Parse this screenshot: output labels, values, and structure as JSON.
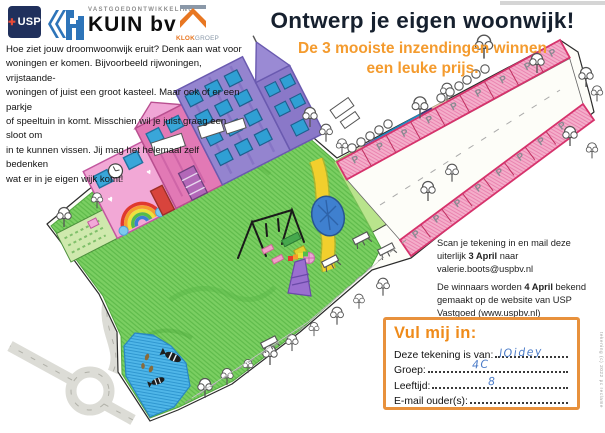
{
  "header": {
    "usp": {
      "label": "USP",
      "plus": "✚",
      "bg": "#20305c",
      "accent": "#e84b37"
    },
    "kuin": {
      "tagline": "VASTGOEDONTWIKKELING",
      "name": "KUIN bv",
      "icon_color": "#2d74b9"
    },
    "klok": {
      "bold": "KLOK",
      "light": "GROEP",
      "chevron_color": "#e87722"
    }
  },
  "intro": {
    "text": "Hoe ziet jouw droomwoonwijk eruit? Denk aan wat voor\nwoningen er komen. Bijvoorbeeld rijwoningen, vrijstaande-\nwoningen of juist een groot kasteel. Maar ook of er een parkje\nof speeltuin in komt. Misschien wil je juist graag een sloot om\nin te kunnen vissen. Jij mag het helemaal zelf bedenken\nwat er in je eigen wijk komt!"
  },
  "title": {
    "text": "Ontwerp je eigen woonwijk!",
    "color": "#16202e"
  },
  "subtitle": {
    "text": "De 3 mooiste inzendingen winnen\neen leuke prijs.",
    "color": "#f49b2e"
  },
  "instructions": {
    "scan_pre": "Scan je tekening in en mail deze\nuiterlijk ",
    "scan_bold": "3 April",
    "scan_post": " naar\nvalerie.boots@uspbv.nl",
    "winners_pre": "De winnaars worden ",
    "winners_bold": "4 April",
    "winners_post": " bekend\ngemaakt op de website van USP\nVastgoed (www.uspbv.nl)"
  },
  "form": {
    "title": "Vul mij in:",
    "border_color": "#e8913c",
    "handwriting_color": "#4a7bc8",
    "fields": [
      {
        "label": "Deze tekening is van:",
        "value": "lOidey"
      },
      {
        "label": "Groep:",
        "value": "4C"
      },
      {
        "label": "Leeftijd:",
        "value": "8"
      },
      {
        "label": "E-mail ouder(s):",
        "value": ""
      }
    ]
  },
  "drawing": {
    "parking_letter": "P"
  },
  "sidenote": {
    "text": "tekening (c) 2022 pc reclame"
  }
}
